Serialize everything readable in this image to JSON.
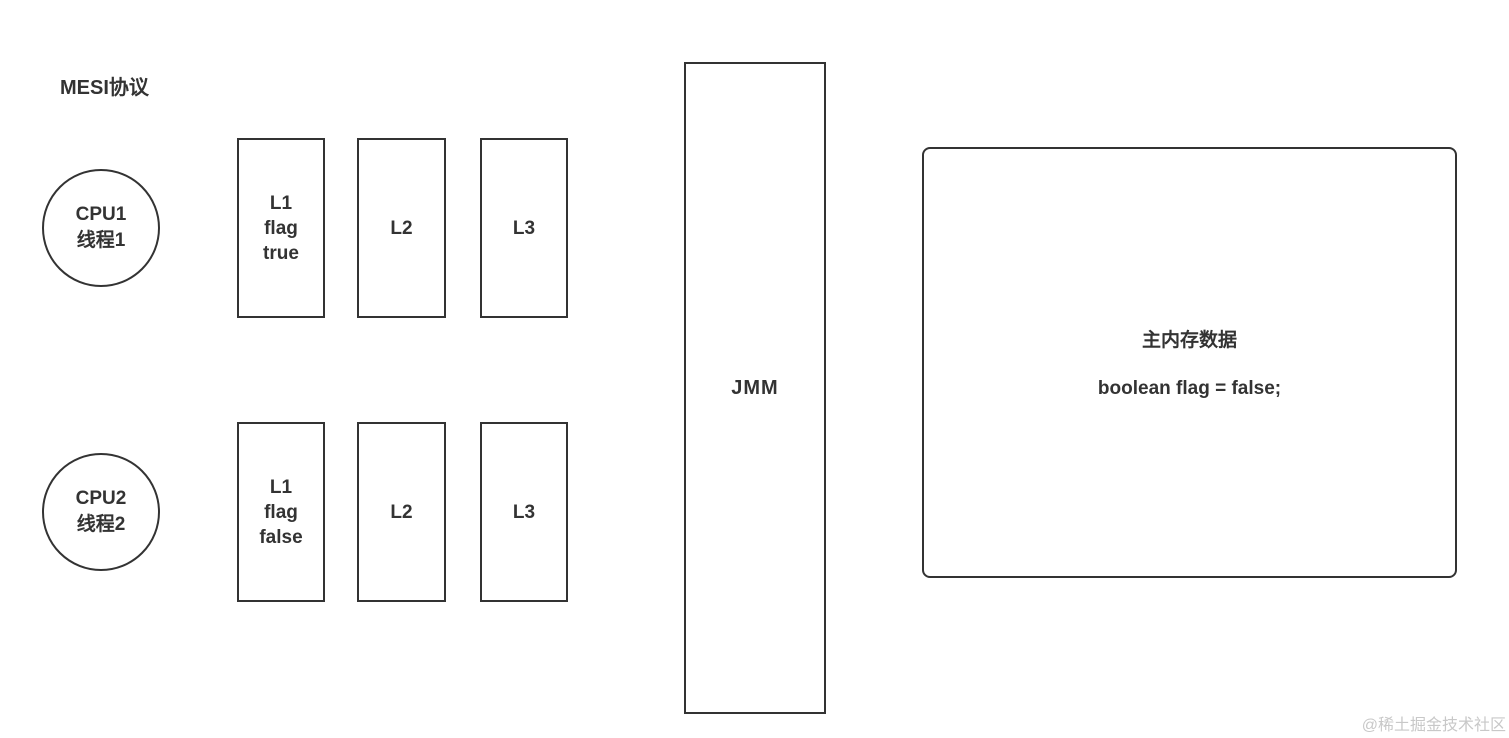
{
  "page": {
    "title": "MESI协议",
    "watermark": "@稀土掘金技术社区"
  },
  "diagram": {
    "cpu1": {
      "lines": [
        "CPU1",
        "线程1"
      ]
    },
    "cpu2": {
      "lines": [
        "CPU2",
        "线程2"
      ]
    },
    "caches_top": {
      "l1": [
        "L1",
        "flag",
        "true"
      ],
      "l2": "L2",
      "l3": "L3"
    },
    "caches_bottom": {
      "l1": [
        "L1",
        "flag",
        "false"
      ],
      "l2": "L2",
      "l3": "L3"
    },
    "jmm": "JMM",
    "main_memory": {
      "title": "主内存数据",
      "code": "boolean flag = false;"
    }
  },
  "colors": {
    "line": "#333333",
    "text": "#333333",
    "watermark": "#c8c8c8",
    "background": "#ffffff"
  }
}
